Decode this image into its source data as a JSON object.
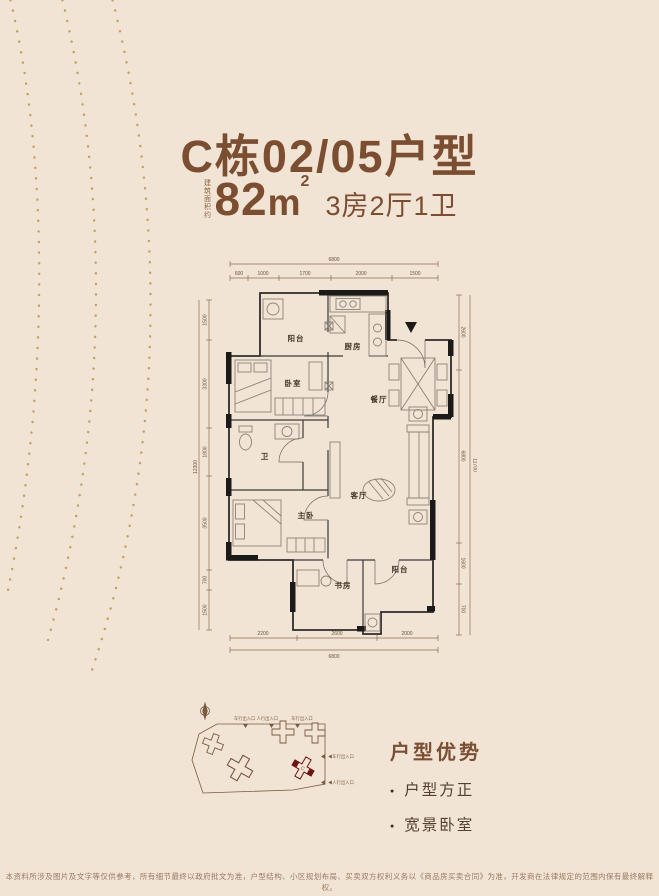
{
  "header": {
    "title": "C栋02/05户型",
    "area_note": "建筑面积约",
    "area_value": "82",
    "area_unit_base": "m",
    "area_unit_sup": "2",
    "spec": "3房2厅1卫"
  },
  "floorplan": {
    "rooms": {
      "balcony_top": "阳台",
      "kitchen": "厨房",
      "bedroom": "卧室",
      "dining": "餐厅",
      "bath": "卫",
      "master": "主卧",
      "living": "客厅",
      "study": "书房",
      "balcony_bottom": "阳台"
    },
    "dims": {
      "top_total": "6800",
      "top_segments": [
        "600",
        "1000",
        "1700",
        "2000",
        "1500"
      ],
      "bottom_total": "6800",
      "bottom_segments": [
        "2200",
        "2600",
        "2000"
      ],
      "left_total": "12300",
      "left_segments": [
        "1500",
        "3300",
        "1800",
        "3500",
        "700",
        "1500"
      ],
      "right_total": "11700",
      "right_segments": [
        "2600",
        "6800",
        "1600",
        "700"
      ]
    }
  },
  "siteplan": {
    "gates_top_1": "车行出入口 人行出入口",
    "gates_top_2": "车行出入口",
    "gate_right_1": "◀车行出入口",
    "gate_right_2": "◀人行出入口",
    "highlight_label": "C"
  },
  "advantages": {
    "heading": "户型优势",
    "items": [
      "户型方正",
      "宽景卧室"
    ]
  },
  "footer": {
    "disclaimer": "本资料所涉及图片及文字等仅供参考，所有细节最终以政府批文为准，户型结构、小区规划布局、买卖双方权利义务以《商品房买卖合同》为准，开发商在法律规定的范围内保有最终解释权。"
  },
  "colors": {
    "background": "#f2e4d5",
    "title_brown": "#7b4e31",
    "dim_brown": "#8a6c50",
    "wall_black": "#1c1a18",
    "gold_dots": "#b9944e",
    "accent_red": "#6e1511"
  }
}
